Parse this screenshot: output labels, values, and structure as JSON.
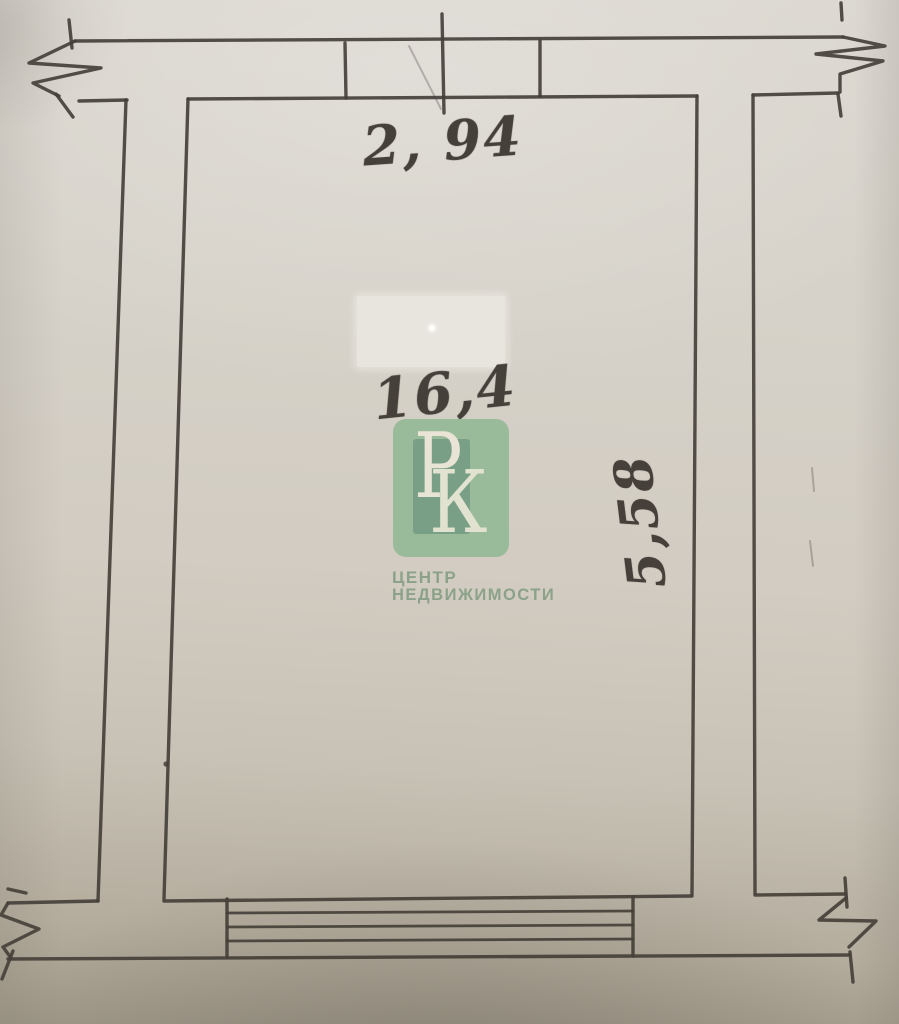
{
  "plan": {
    "dimensions": {
      "top_width": "2, 94",
      "area": "16,4",
      "side_height": "5,58"
    },
    "watermark": {
      "letter_p": "Р",
      "letter_k": "К",
      "caption_line1": "ЦЕНТР",
      "caption_line2": "НЕДВИЖИМОСТИ"
    }
  },
  "colors": {
    "ink": "#45403a",
    "paper-light": "#dbd7d0",
    "paper-mid": "#d2ccc2",
    "paper-dark": "#a0998a",
    "wm-green": "#93b995",
    "wm-green-dark": "#6d9a7e",
    "wm-letter": "#ece8d8",
    "wm-caption": "#7f9b80",
    "redaction": "#e8e5de"
  }
}
